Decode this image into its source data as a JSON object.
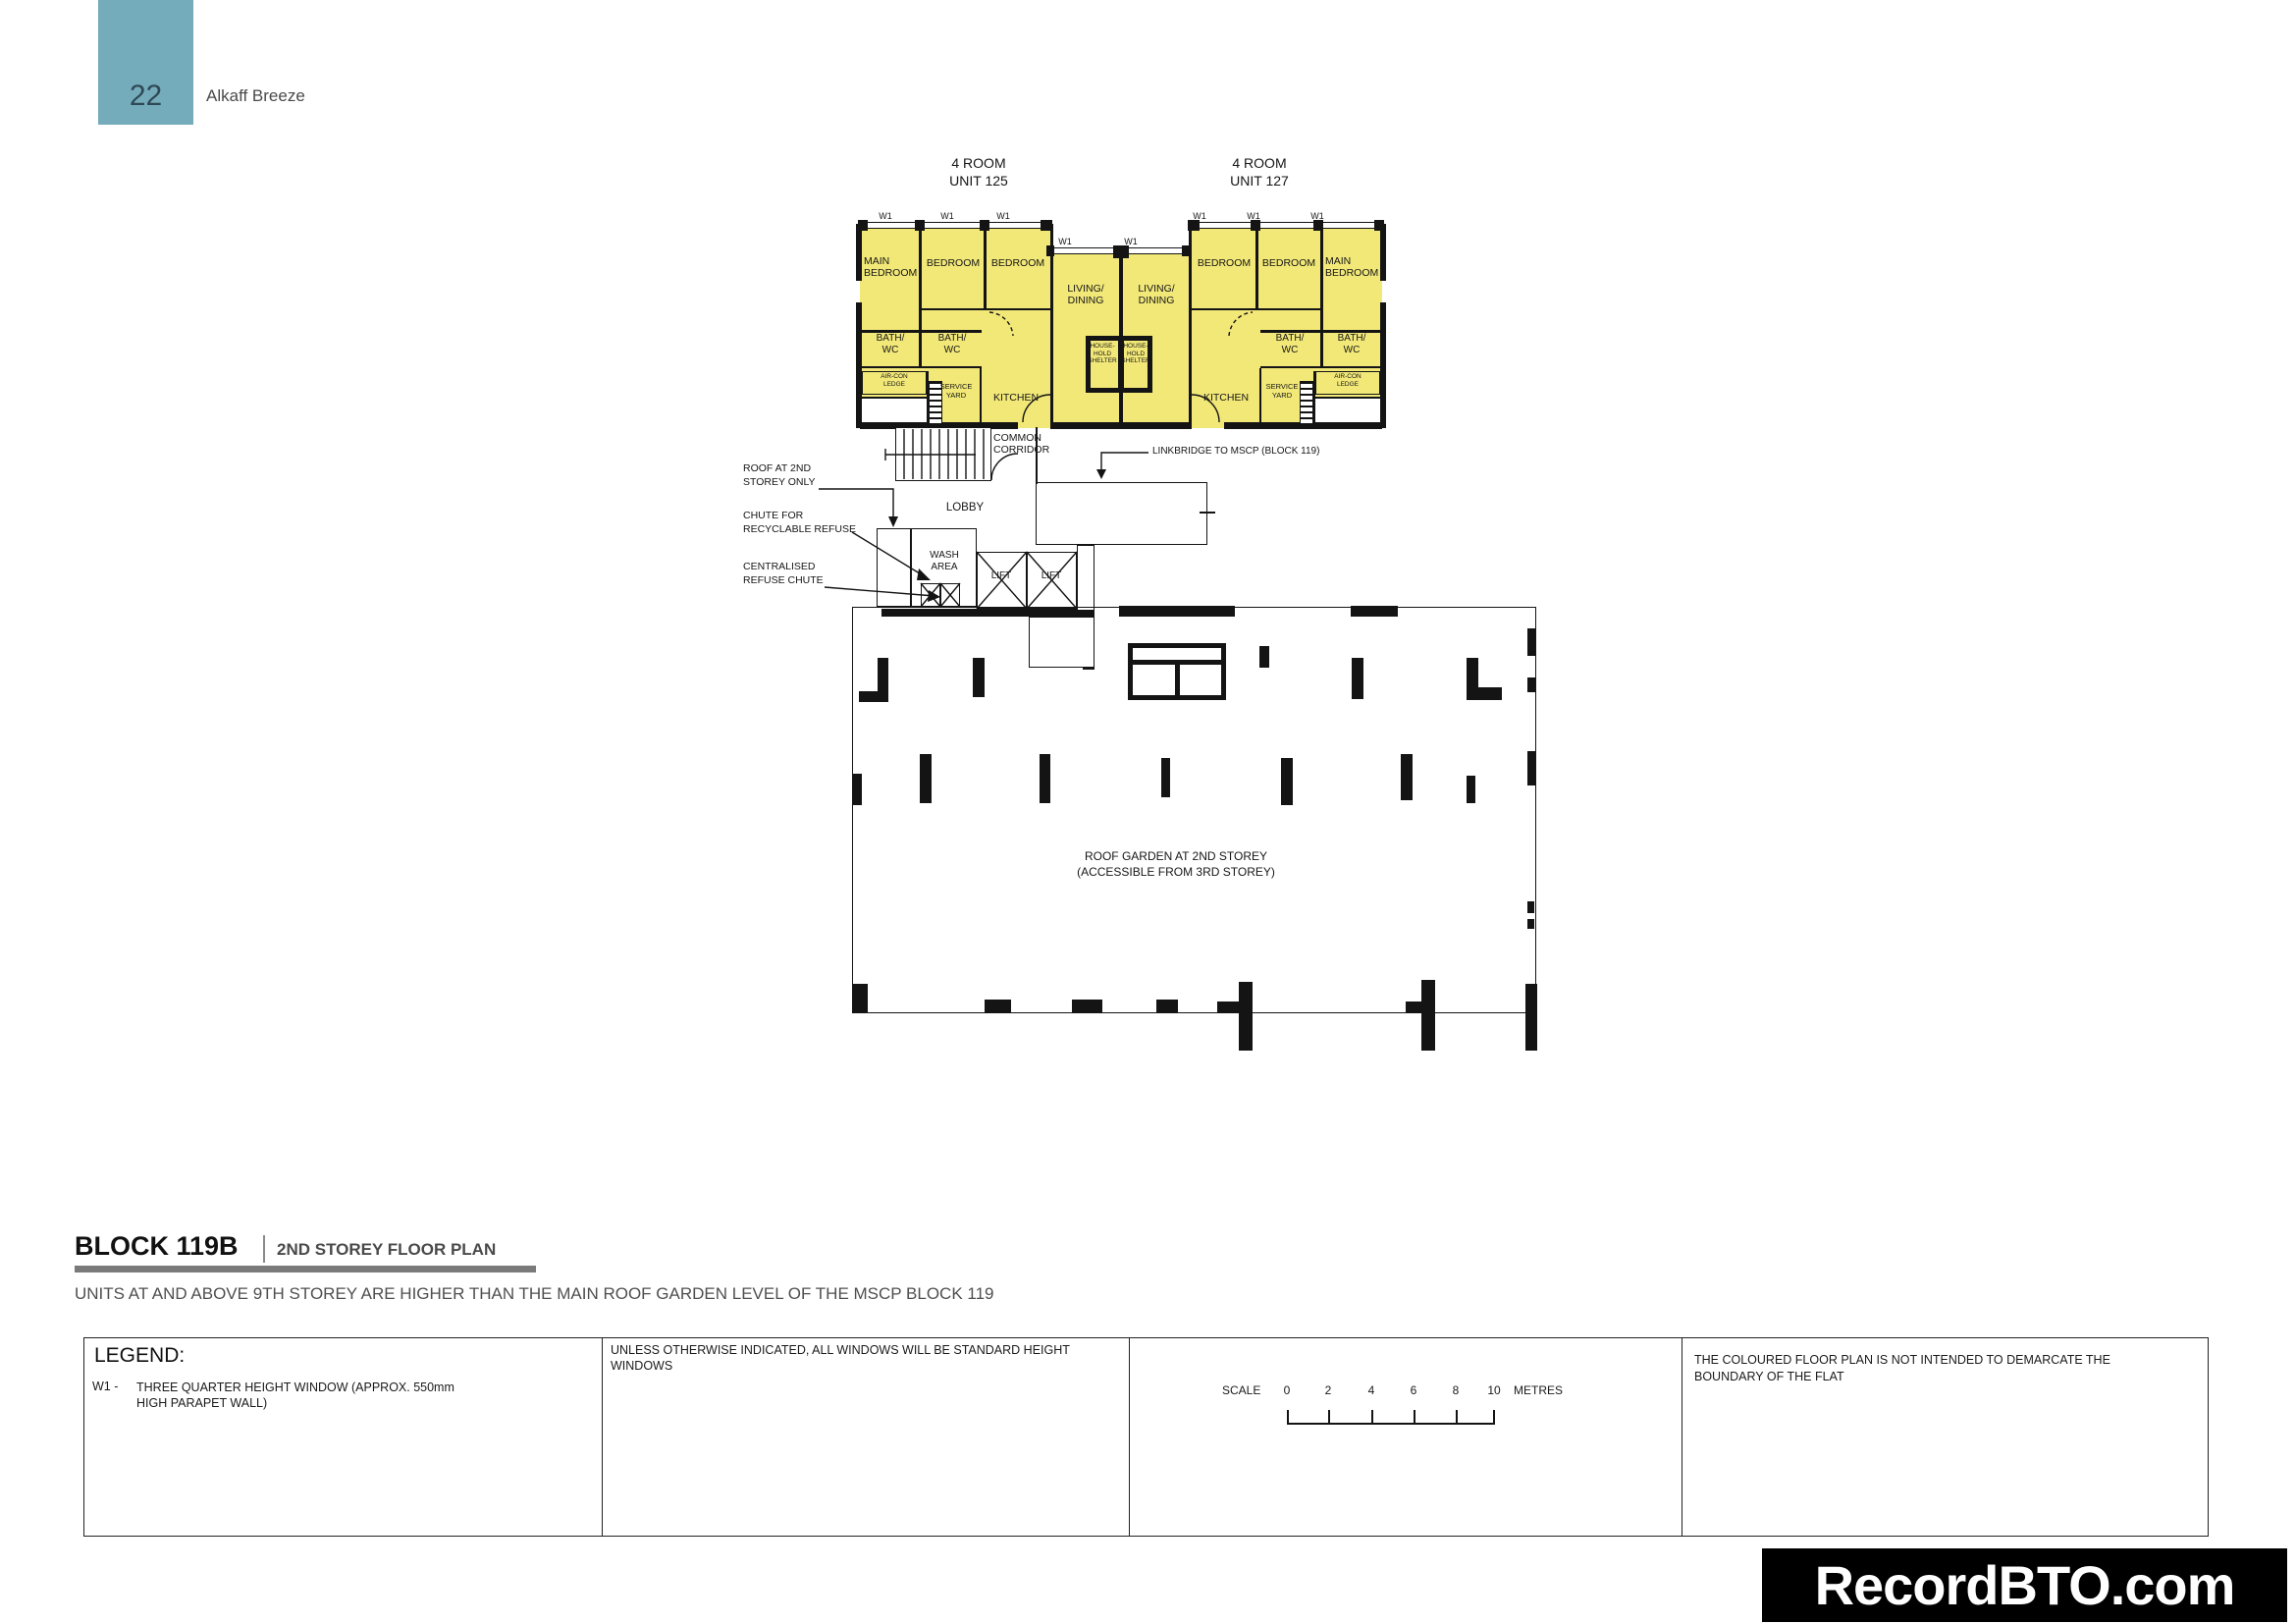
{
  "colors": {
    "unit_fill": "#f2e878",
    "header_box": "#75acbb",
    "wall": "#141414",
    "watermark_bg": "#000000",
    "watermark_text": "#ffffff",
    "title_bar": "#7a7a7a"
  },
  "header": {
    "page_number": "22",
    "project_name": "Alkaff Breeze"
  },
  "plan": {
    "units": [
      {
        "type": "4 ROOM",
        "unit": "UNIT 125"
      },
      {
        "type": "4 ROOM",
        "unit": "UNIT 127"
      }
    ],
    "window_code": "W1",
    "room_labels": {
      "main_bedroom": "MAIN BEDROOM",
      "bedroom": "BEDROOM",
      "living_dining": "LIVING/ DINING",
      "bath_wc": "BATH/ WC",
      "aircon_ledge": "AIR-CON LEDGE",
      "service_yard": "SERVICE YARD",
      "kitchen": "KITCHEN",
      "household_shelter": "HOUSE- HOLD SHELTER",
      "common_corridor": "COMMON CORRIDOR",
      "lobby": "LOBBY",
      "wash_area": "WASH AREA",
      "lift": "LIFT"
    },
    "annotations": {
      "roof_l1": "ROOF AT 2ND",
      "roof_l2": "STOREY ONLY",
      "recycle_l1": "CHUTE FOR",
      "recycle_l2": "RECYCLABLE REFUSE",
      "refuse_l1": "CENTRALISED",
      "refuse_l2": "REFUSE CHUTE",
      "linkbridge": "LINKBRIDGE TO MSCP (BLOCK 119)",
      "roof_garden_l1": "ROOF GARDEN AT 2ND STOREY",
      "roof_garden_l2": "(ACCESSIBLE FROM 3RD STOREY)"
    }
  },
  "title_block": {
    "block": "BLOCK 119B",
    "plan_title": "2ND STOREY FLOOR PLAN",
    "note": "UNITS AT AND ABOVE 9TH STOREY ARE HIGHER THAN THE MAIN ROOF GARDEN LEVEL OF THE MSCP BLOCK 119"
  },
  "legend": {
    "heading": "LEGEND:",
    "items": [
      {
        "code": "W1 -",
        "description": "THREE QUARTER HEIGHT WINDOW (APPROX. 550mm HIGH PARAPET WALL)"
      }
    ],
    "windows_note": "UNLESS OTHERWISE INDICATED,  ALL WINDOWS WILL BE STANDARD HEIGHT WINDOWS",
    "scale": {
      "label": "SCALE",
      "ticks": [
        "0",
        "2",
        "4",
        "6",
        "8",
        "10"
      ],
      "unit": "METRES"
    },
    "boundary_note": "THE COLOURED FLOOR PLAN IS NOT INTENDED TO DEMARCATE THE BOUNDARY OF THE FLAT"
  },
  "watermark": "RecordBTO.com"
}
